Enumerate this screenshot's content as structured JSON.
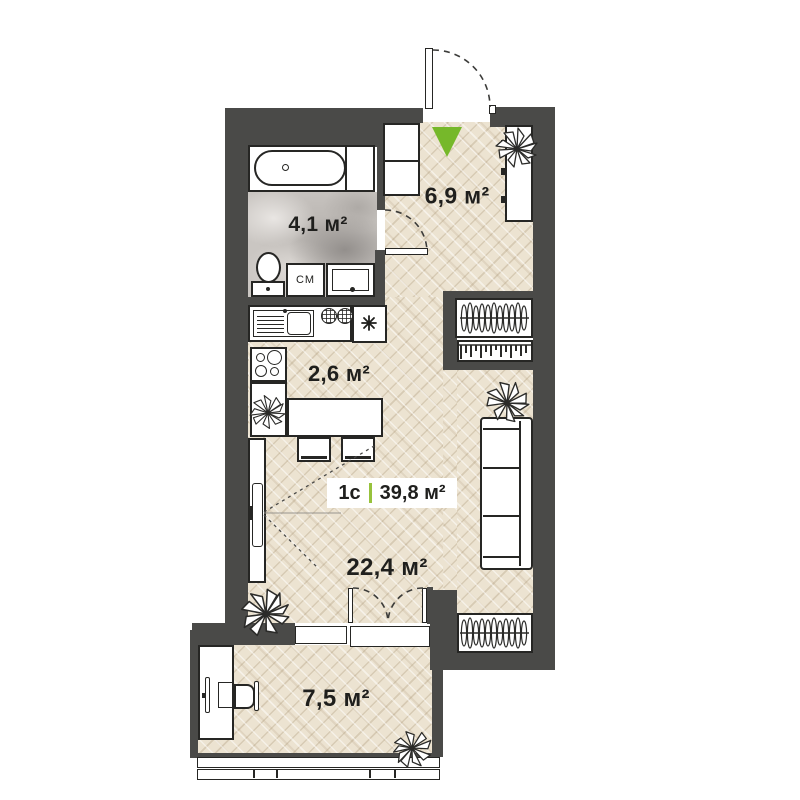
{
  "plan": {
    "unit": {
      "type_label": "1с",
      "area_label": "39,8 м²"
    },
    "rooms": {
      "hallway": {
        "area_label": "6,9 м²"
      },
      "bathroom": {
        "area_label": "4,1 м²"
      },
      "kitchen": {
        "area_label": "2,6 м²"
      },
      "living_room": {
        "area_label": "22,4 м²"
      },
      "balcony": {
        "area_label": "7,5 м²"
      }
    },
    "appliances": {
      "washing_machine_label": "СМ"
    },
    "icons": {
      "entrance_marker": "green-triangle-icon",
      "fridge": "snowflake-asterisk-icon",
      "wardrobe": "hangers-icon",
      "plants": "spiky-plant-icon"
    },
    "colors": {
      "wall": "#4a4a48",
      "parquet": "#ece3d1",
      "marble": "#cac6c2",
      "entrance_green": "#76b82a",
      "divider_green": "#97c23c",
      "text": "#1f1f1d",
      "furniture_outline": "#262624",
      "background": "#ffffff"
    }
  }
}
